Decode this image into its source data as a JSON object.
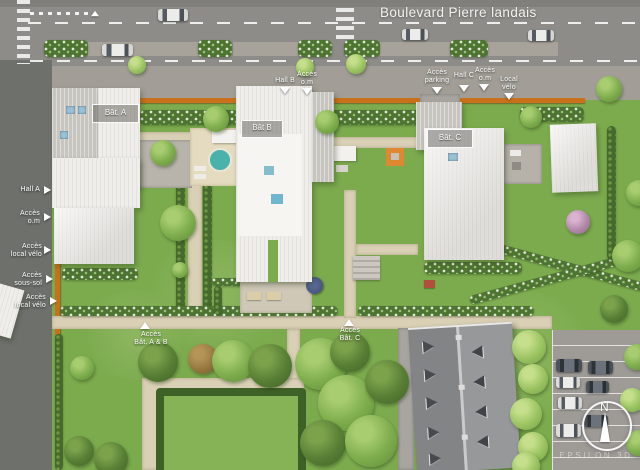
{
  "street": {
    "name": "Boulevard Pierre landais"
  },
  "buildings": {
    "bat_a": "Bât. A",
    "bat_b": "Bât B",
    "bat_c": "Bât. C"
  },
  "access_labels": {
    "hall_a": "Hall A",
    "acces_om_left": "Accès\no.m",
    "acces_local_velo_upper": "Accès\nlocal vélo",
    "acces_sous_sol": "Accès\nsous-sol",
    "acces_local_velo_lower": "Accès\nlocal vélo",
    "hall_b": "Hall B",
    "acces_om_bat_b": "Accès\no.m",
    "acces_parking": "Accès\nparking",
    "hall_c": "Hall C",
    "acces_om_bat_c": "Accès\no.m",
    "local_velo": "Local\nvélo",
    "acces_bat_a_b": "Accès\nBât. A & B",
    "acces_bat_c": "Accès\nBât. C"
  },
  "compass": {
    "north": "N"
  },
  "watermark": "EPSILON 3D",
  "colors": {
    "lawn": "#7cab4e",
    "boulevard": "#8d8c88",
    "side_road": "#6e706c",
    "gravel_path": "#d9d0b5",
    "orange_hedge": "#c9701d",
    "roof_white": "#f0eeea",
    "roof_dark": "#96989a",
    "pool_blue": "#49b2ab",
    "label_text": "#ffffff"
  }
}
